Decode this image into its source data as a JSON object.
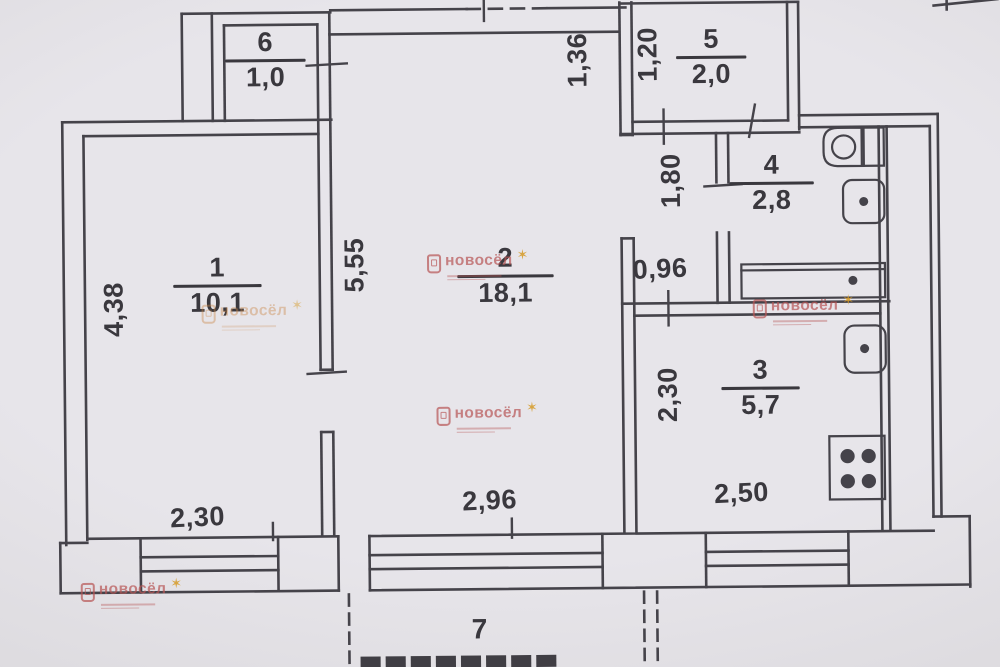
{
  "title": "apartment-floor-plan",
  "rooms": [
    {
      "number": "1",
      "area": "10,1"
    },
    {
      "number": "2",
      "area": "18,1"
    },
    {
      "number": "3",
      "area": "5,7"
    },
    {
      "number": "4",
      "area": "2,8"
    },
    {
      "number": "5",
      "area": "2,0"
    },
    {
      "number": "6",
      "area": "1,0"
    },
    {
      "number": "7",
      "area": ""
    }
  ],
  "dimensions": {
    "room1_height": "4,38",
    "room1_width": "2,30",
    "room2_height": "5,55",
    "room2_width": "2,96",
    "room3_height": "2,30",
    "room3_width": "2,50",
    "room5_width": "1,20",
    "entry_niche": "1,36",
    "hall_length": "1,80",
    "hall_width": "0,96"
  },
  "watermark": {
    "brand": "новосёл"
  }
}
